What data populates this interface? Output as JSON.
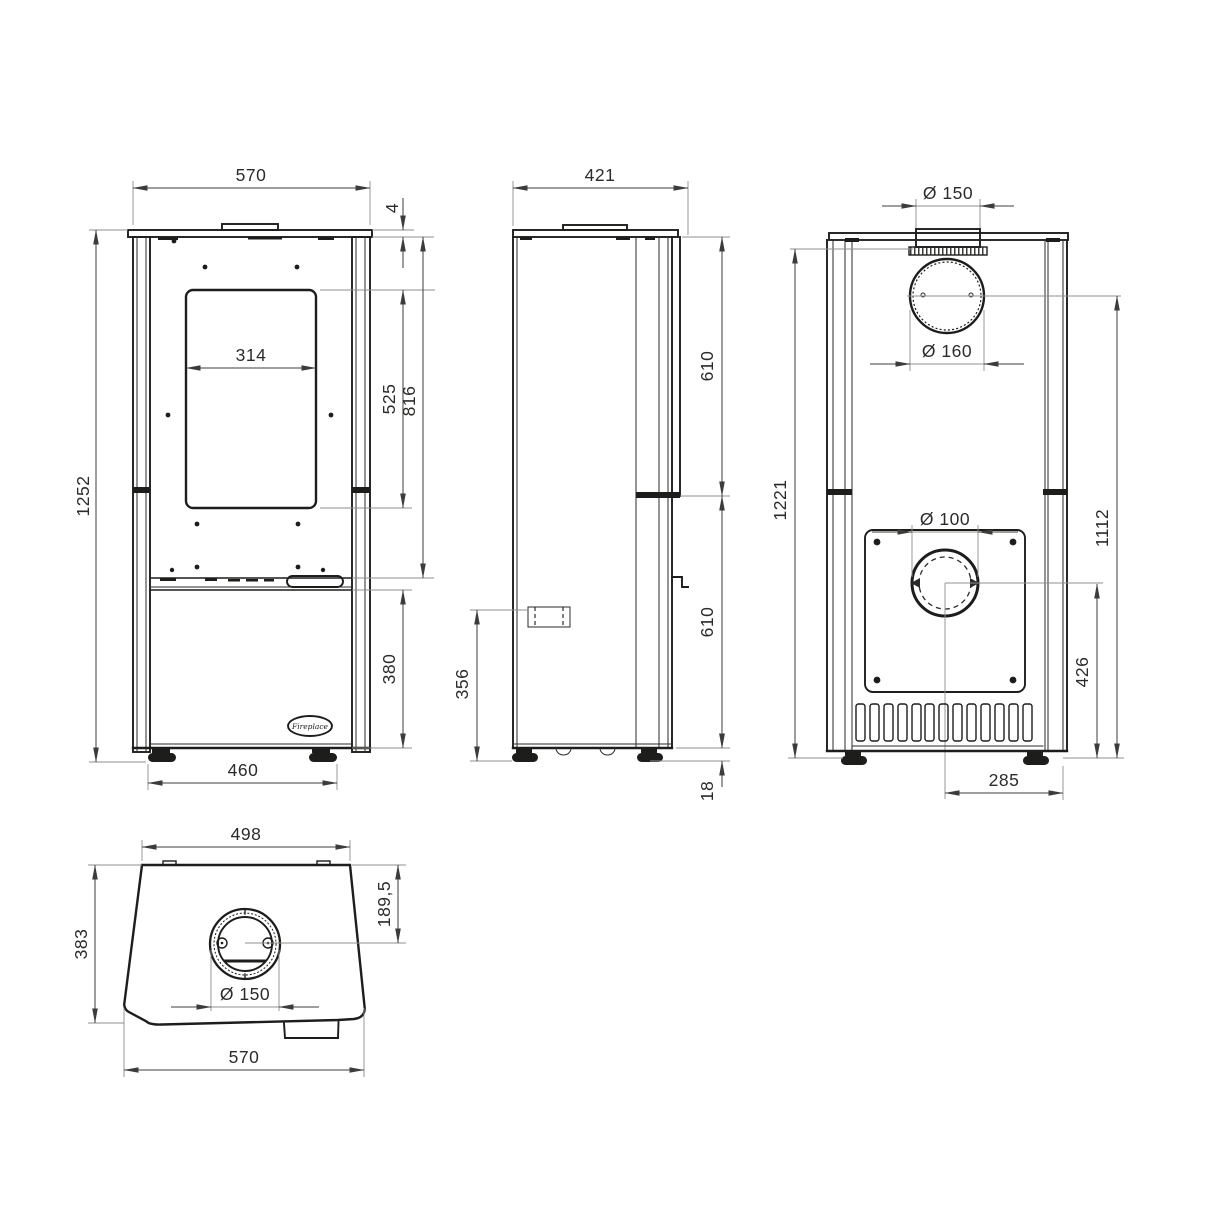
{
  "drawing": {
    "front": {
      "dims": {
        "width_top": "570",
        "plate_thickness": "4",
        "total_height": "1252",
        "glass_width": "314",
        "glass_height": "525",
        "firebox_top_height": "816",
        "lower_door_height": "380",
        "feet_spacing": "460"
      },
      "logo_text": "Fireplace"
    },
    "side": {
      "dims": {
        "depth": "421",
        "upper_height": "610",
        "lower_height": "610",
        "outlet_height": "356",
        "foot_height": "18"
      }
    },
    "rear": {
      "dims": {
        "top_flue": "Ø 150",
        "rear_flue": "Ø 160",
        "body_height": "1221",
        "flue_center_height": "1112",
        "air_inlet": "Ø 100",
        "air_center_height": "426",
        "air_center_offset": "285"
      }
    },
    "top": {
      "dims": {
        "top_width": "498",
        "depth": "383",
        "flue_center_offset": "189,5",
        "flue": "Ø 150",
        "bottom_width": "570"
      }
    },
    "colors": {
      "line": "#1d1d1b",
      "dimension": "#3c3c3a",
      "extension": "#8f8f8d",
      "background": "#ffffff"
    }
  }
}
